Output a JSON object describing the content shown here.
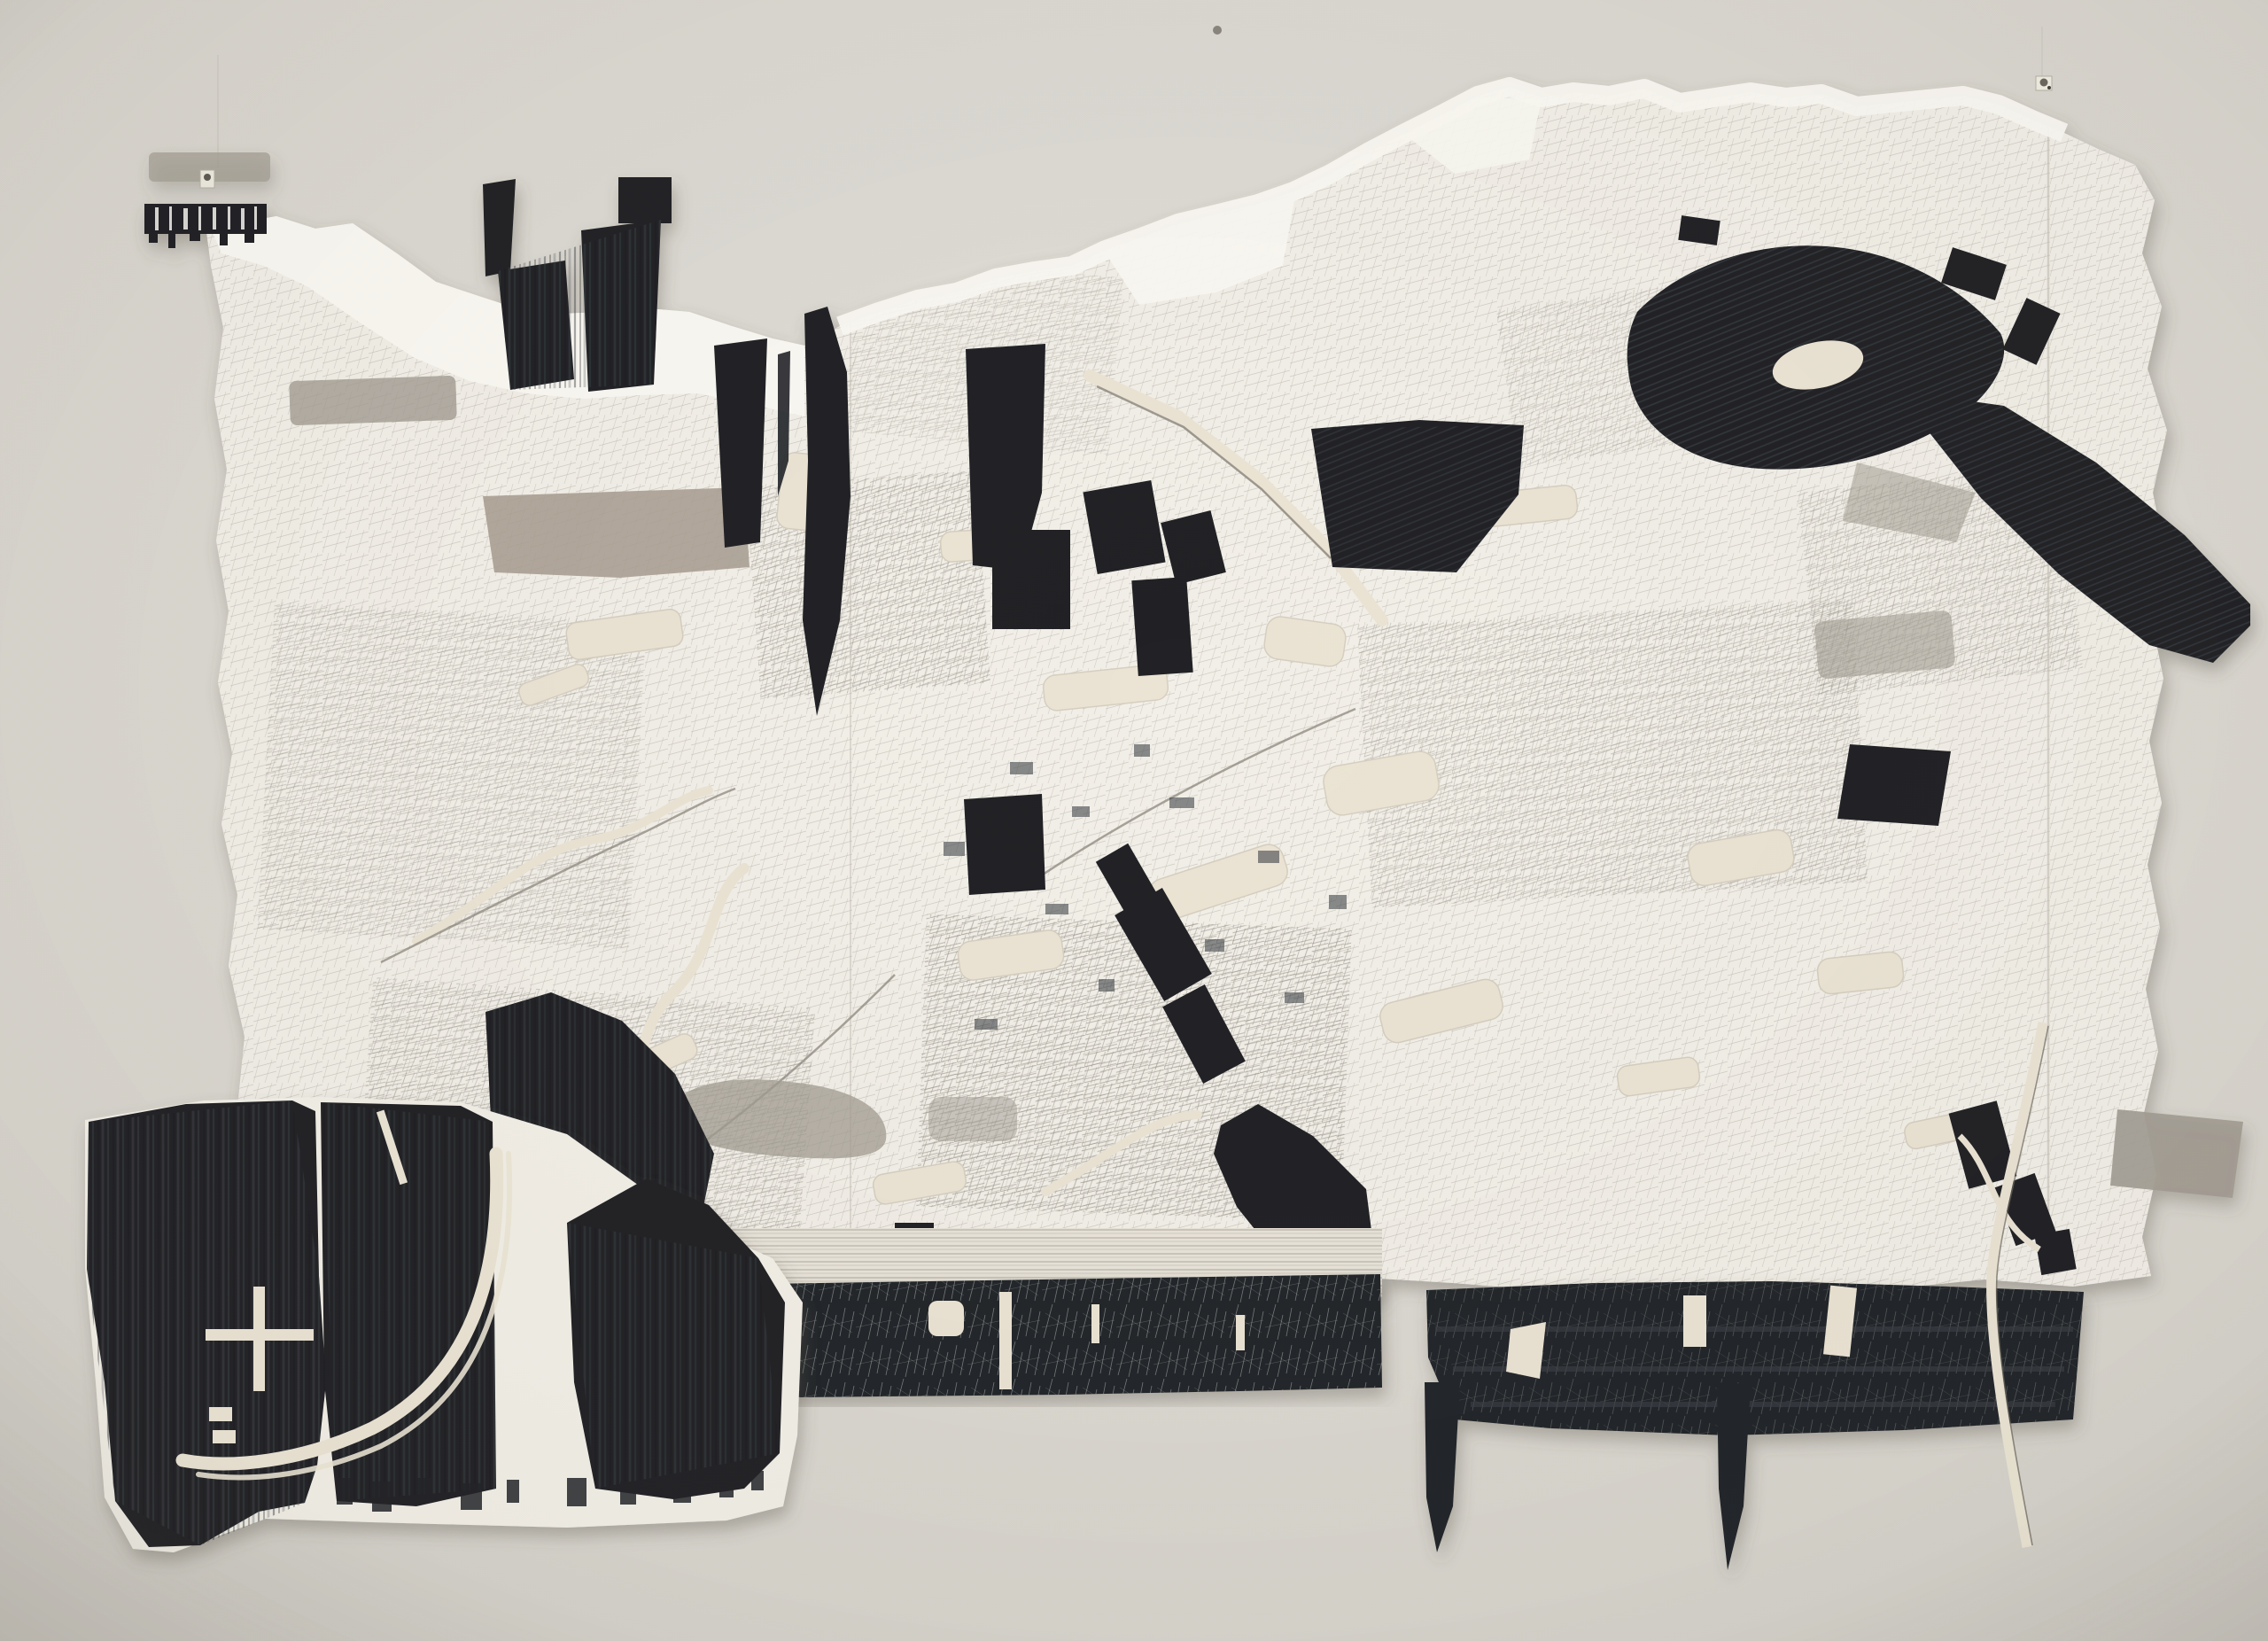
{
  "scene": {
    "type": "photograph",
    "subject": "large abstract mixed-media collage drawing pinned to a gallery wall",
    "style": "black ink brushwork, gray washes and fine pencil cross-hatching on torn and cut paper; aerial map-like composition",
    "visible_text": "none"
  },
  "palette": {
    "wall-light": "#e3e0da",
    "wall-dark": "#c9c6bf",
    "paper": "#f2efe8",
    "paper-white": "#faf8f2",
    "backing-cream": "#ebe4d4",
    "hatch": "#a19c93",
    "hatch-dense": "#6e695f",
    "wash-gray": "#a29c92",
    "wash-taupe": "#a89e92",
    "ink": "#212428",
    "ink-soft": "#41454a",
    "band": "#23272b",
    "scratch": "#d7d9d8",
    "accent-red": "#6b3a32",
    "shadow": "#5a5348"
  },
  "regions": [
    {
      "name": "wall",
      "note": "pale warm gray wall, soft vignette"
    },
    {
      "name": "mounting-pins",
      "note": "three small pins along the top edge"
    },
    {
      "name": "main-sheet",
      "note": "torn-edged hatched paper sheet, map-like field"
    },
    {
      "name": "torn-white-top-edge",
      "note": "unmarked white torn band along upper edge"
    },
    {
      "name": "cutout-holes",
      "note": "cream backing visible through cut-away shapes"
    },
    {
      "name": "gray-washes",
      "note": "translucent gray brush bars and patches"
    },
    {
      "name": "ink-top-left-fringe",
      "note": "small black fringed strip, upper left"
    },
    {
      "name": "ink-center-cluster",
      "note": "dark angular slivers and blade, center left"
    },
    {
      "name": "ink-right-mass",
      "note": "large brushy black blob, upper right"
    },
    {
      "name": "ink-right-diagonal",
      "note": "long black diagonal streak to right edge"
    },
    {
      "name": "ink-bottom-diagonal",
      "note": "black diagonal chain, lower center right"
    },
    {
      "name": "bottom-band-left",
      "note": "scratched charcoal band with slit cutouts"
    },
    {
      "name": "bottom-band-right",
      "note": "brushy black band with torn notches"
    },
    {
      "name": "bottom-left-panel",
      "note": "solid black inked panel with white curved road cut"
    },
    {
      "name": "panel-arc-road",
      "note": "double white arc cut through black panel"
    },
    {
      "name": "panel-cross-mark",
      "note": "white cross cut-out in black panel"
    },
    {
      "name": "white-sliver",
      "note": "thin pale paper strip crossing right band"
    }
  ]
}
